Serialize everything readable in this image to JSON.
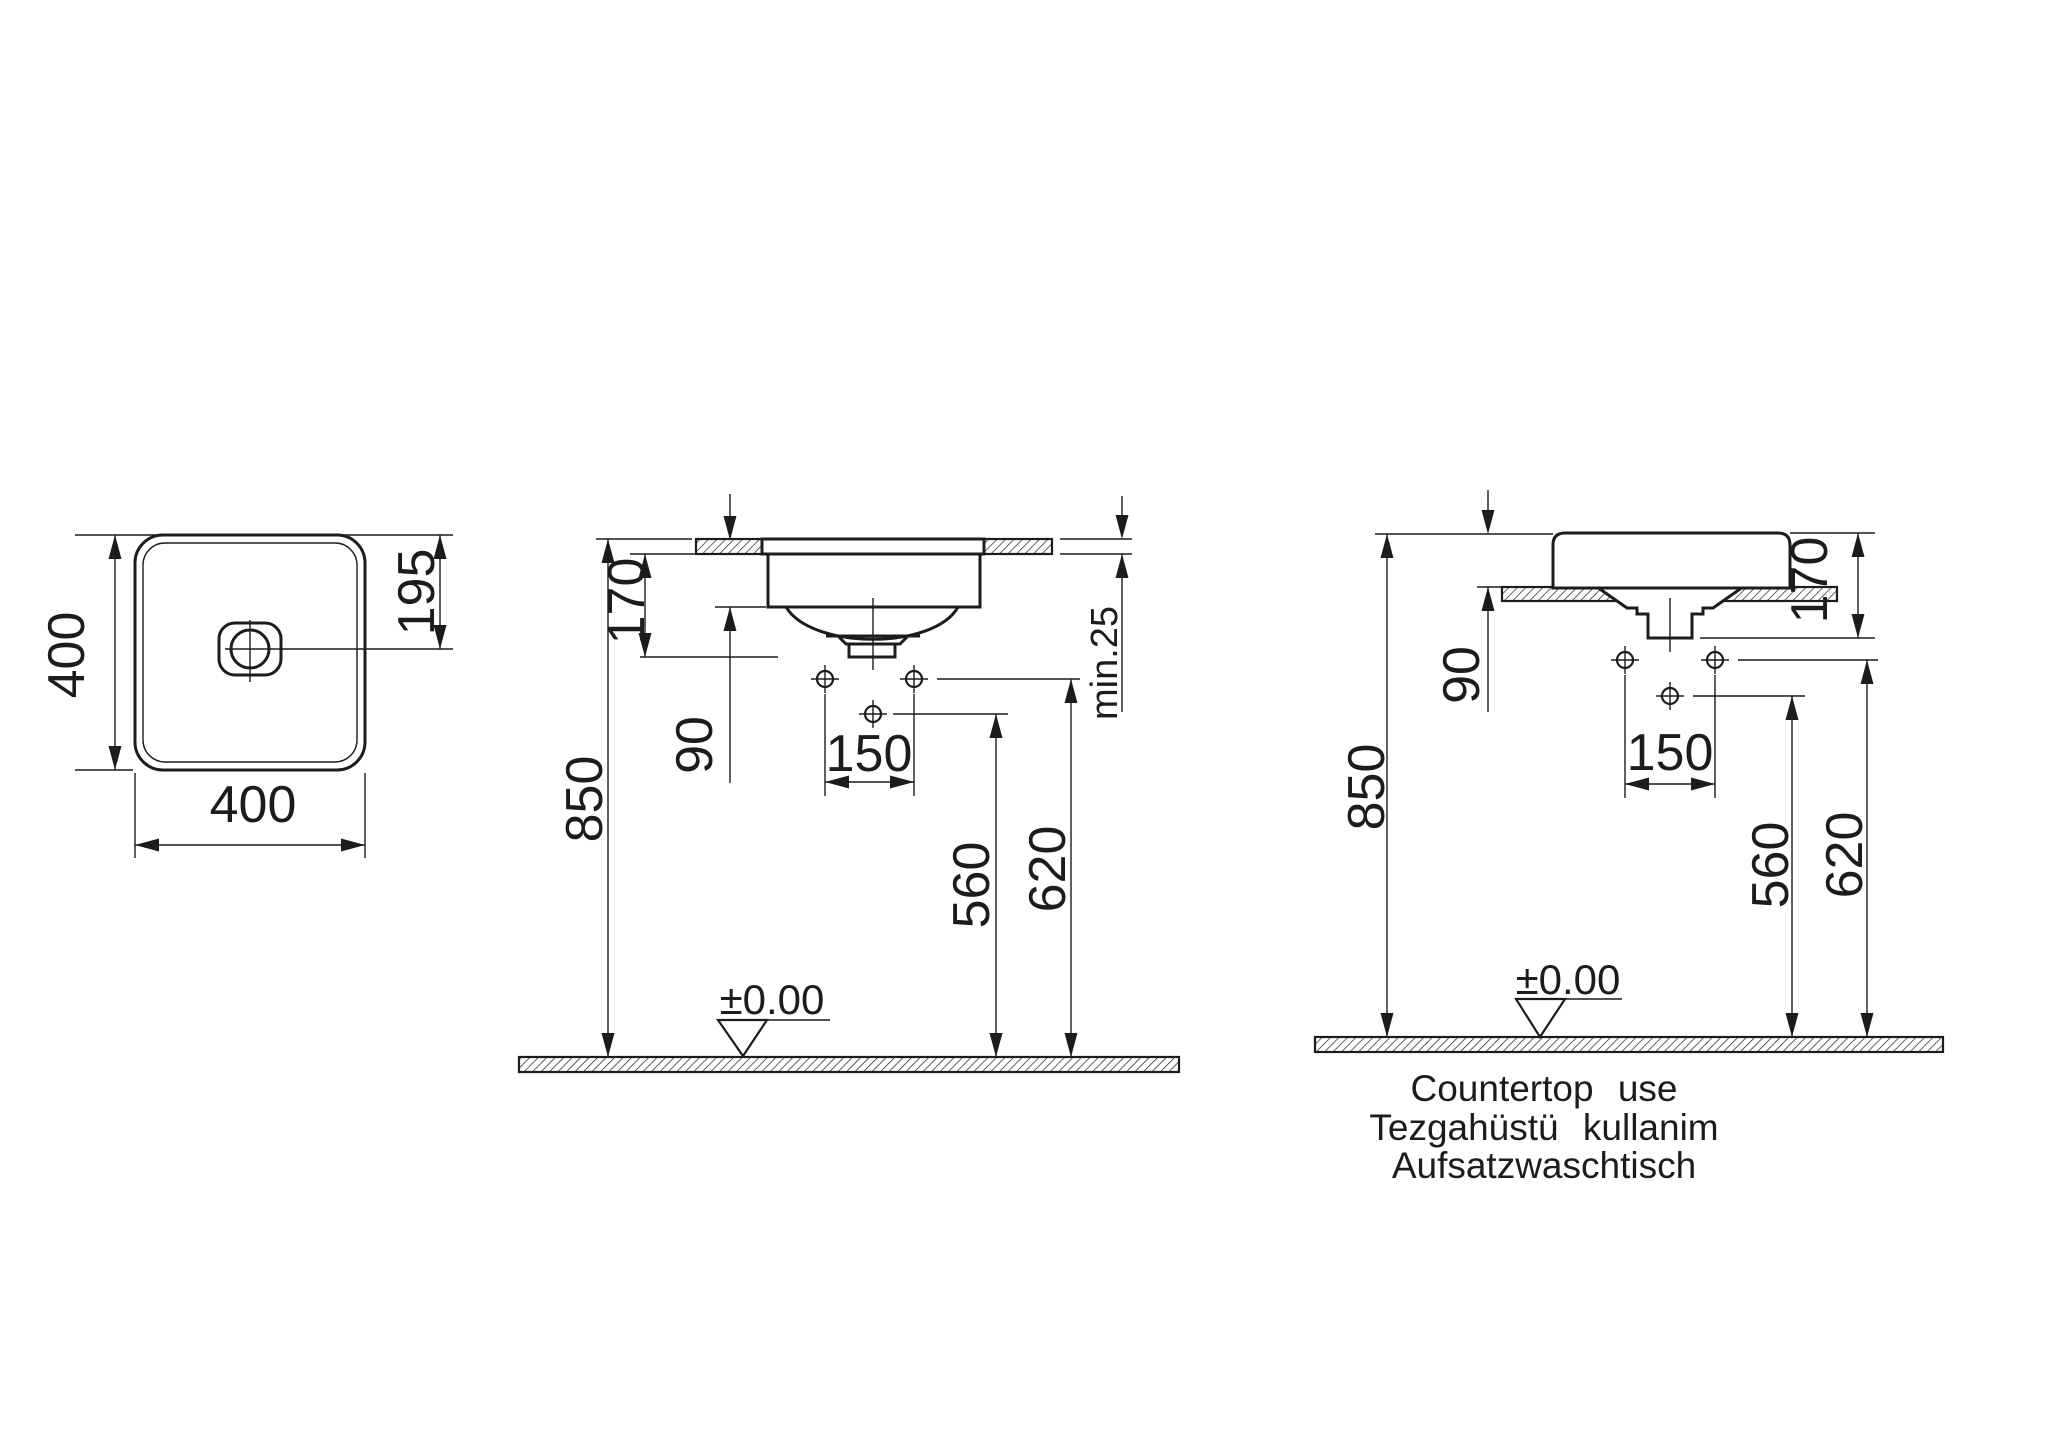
{
  "colors": {
    "line": "#1c1c1c",
    "background": "#ffffff"
  },
  "plan_view": {
    "width_label": "400",
    "depth_label": "400",
    "drain_offset_label": "195"
  },
  "semi_recessed_view": {
    "basin_height_label": "170",
    "below_counter_label": "90",
    "tap_hole_spacing_label": "150",
    "rim_height_label": "850",
    "mixer_supply_height_label": "560",
    "side_supply_height_label": "620",
    "counter_thickness_label": "min.25",
    "floor_datum_label": "±0.00"
  },
  "countertop_view": {
    "basin_height_label": "170",
    "above_counter_label": "90",
    "tap_hole_spacing_label": "150",
    "rim_height_label": "850",
    "mixer_supply_height_label": "560",
    "side_supply_height_label": "620",
    "floor_datum_label": "±0.00",
    "caption_line1": "Countertop use",
    "caption_line2": "Tezgahüstü kullanim",
    "caption_line3": "Aufsatzwaschtisch"
  }
}
